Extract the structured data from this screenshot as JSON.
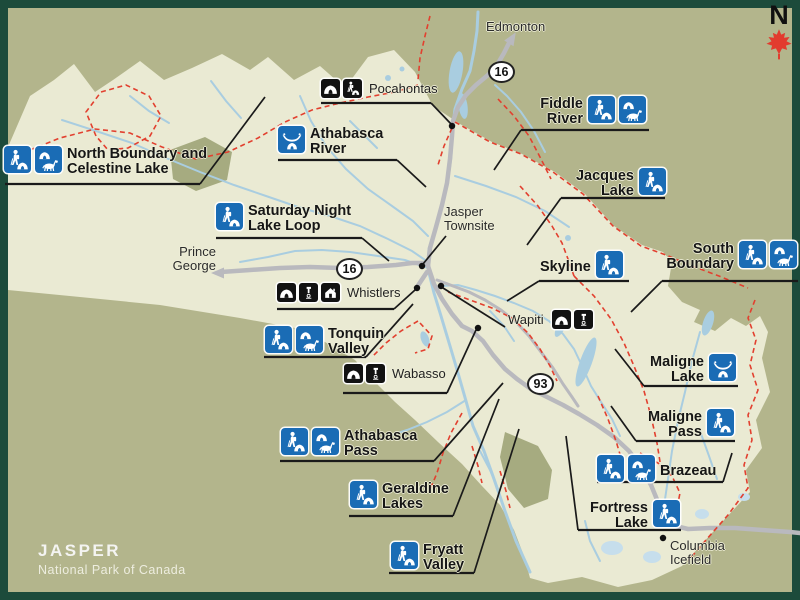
{
  "brand": {
    "park": "JASPER",
    "subtitle": "National Park of Canada"
  },
  "north": {
    "label": "N",
    "icon": "maple-leaf-icon"
  },
  "shields": {
    "hwy16": "16",
    "hwy93": "93"
  },
  "colors": {
    "frame": "#1c4b3b",
    "bg": "#b3b58c",
    "park": "#eaead3",
    "park_dark": "#a6ab80",
    "river": "#a9cde0",
    "glacier": "#c6deec",
    "road": "#b9b9be",
    "trail": "#e2402f",
    "badge_blue": "#1a6cb5",
    "badge_black": "#121212",
    "ink": "#1a1a1a",
    "leaf": "#e23b2e"
  },
  "cities": {
    "edmonton": "Edmonton",
    "prince_george_l1": "Prince",
    "prince_george_l2": "George",
    "jasper_l1": "Jasper",
    "jasper_l2": "Townsite",
    "columbia_l1": "Columbia",
    "columbia_l2": "Icefield"
  },
  "campgrounds": {
    "pocahontas": {
      "name": "Pocahontas",
      "icons": [
        "campground",
        "backcountry-camping"
      ]
    },
    "whistlers": {
      "name": "Whistlers",
      "icons": [
        "campground",
        "sani-dump",
        "interpretive-centre"
      ]
    },
    "wapiti": {
      "name": "Wapiti",
      "icons": [
        "campground",
        "sani-dump"
      ]
    },
    "wabasso": {
      "name": "Wabasso",
      "icons": [
        "campground",
        "sani-dump"
      ]
    }
  },
  "trails": {
    "north_boundary": {
      "line1": "North Boundary and",
      "line2": "Celestine Lake",
      "icons": [
        "hiking-camping",
        "horse-camping"
      ]
    },
    "athabasca_river": {
      "line1": "Athabasca",
      "line2": "River",
      "icons": [
        "canoe-camping"
      ]
    },
    "saturday_night": {
      "line1": "Saturday Night",
      "line2": "Lake Loop",
      "icons": [
        "hiking-camping"
      ]
    },
    "fiddle_river": {
      "line1": "Fiddle",
      "line2": "River",
      "icons": [
        "hiking-camping",
        "horse-camping"
      ]
    },
    "jacques_lake": {
      "line1": "Jacques",
      "line2": "Lake",
      "icons": [
        "hiking-camping"
      ]
    },
    "skyline": {
      "line1": "Skyline",
      "icons": [
        "hiking-camping"
      ]
    },
    "south_boundary": {
      "line1": "South",
      "line2": "Boundary",
      "icons": [
        "hiking-camping",
        "horse-camping"
      ]
    },
    "tonquin_valley": {
      "line1": "Tonquin",
      "line2": "Valley",
      "icons": [
        "hiking-camping",
        "horse-camping"
      ]
    },
    "athabasca_pass": {
      "line1": "Athabasca",
      "line2": "Pass",
      "icons": [
        "hiking-camping",
        "horse-camping"
      ]
    },
    "geraldine_lakes": {
      "line1": "Geraldine",
      "line2": "Lakes",
      "icons": [
        "hiking-camping"
      ]
    },
    "fryatt_valley": {
      "line1": "Fryatt",
      "line2": "Valley",
      "icons": [
        "hiking-camping"
      ]
    },
    "maligne_lake": {
      "line1": "Maligne",
      "line2": "Lake",
      "icons": [
        "canoe-camping"
      ]
    },
    "maligne_pass": {
      "line1": "Maligne",
      "line2": "Pass",
      "icons": [
        "hiking-camping"
      ]
    },
    "brazeau": {
      "line1": "Brazeau",
      "icons": [
        "hiking-camping",
        "horse-camping"
      ]
    },
    "fortress_lake": {
      "line1": "Fortress",
      "line2": "Lake",
      "icons": [
        "hiking-camping"
      ]
    }
  }
}
